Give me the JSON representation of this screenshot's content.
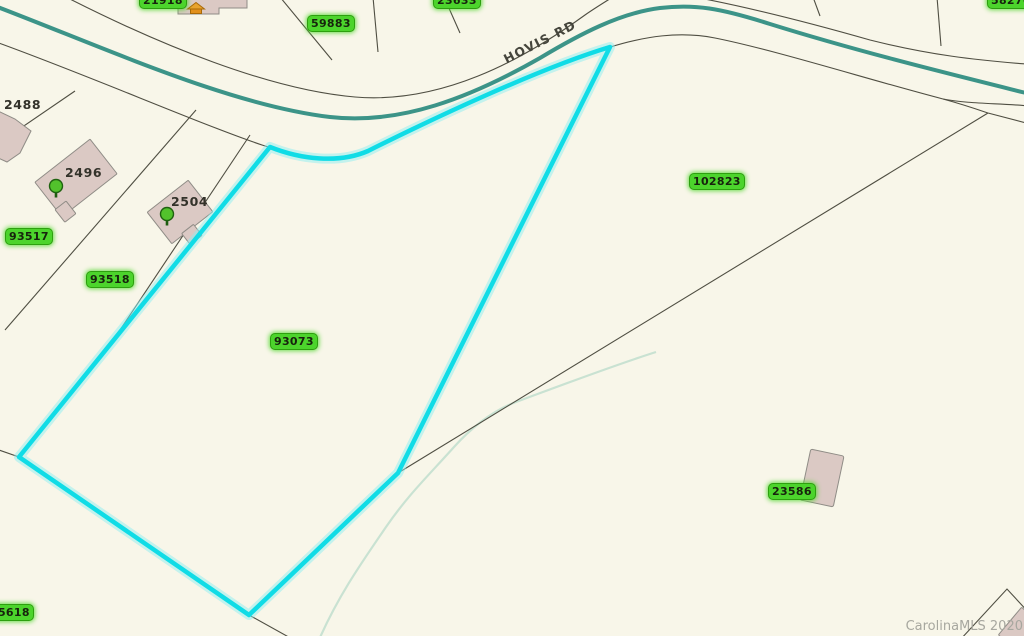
{
  "road": {
    "label": "HOVIS RD"
  },
  "watermark": {
    "label": "CarolinaMLS 2020"
  },
  "parcel_badges": [
    {
      "id": "21918"
    },
    {
      "id": "23633"
    },
    {
      "id": "58276"
    },
    {
      "id": "59883"
    },
    {
      "id": "102823"
    },
    {
      "id": "93073"
    },
    {
      "id": "93517"
    },
    {
      "id": "93518"
    },
    {
      "id": "23586"
    },
    {
      "id": "95618"
    }
  ],
  "address_labels": [
    {
      "number": "2488"
    },
    {
      "number": "2496"
    },
    {
      "number": "2504"
    }
  ],
  "icons": [
    {
      "name": "house-icon"
    },
    {
      "name": "tree-icon"
    }
  ],
  "colors": {
    "background": "#f8f6e9",
    "highlight_parcel_outline": "#10dce6",
    "road_centerline": "#3c9488",
    "parcel_badge_fill": "#4cd42c",
    "building_fill": "#dbc9c4",
    "boundary_line": "#4f4e42",
    "creek": "#c9e2d2",
    "watermark_text": "#a7a79f"
  }
}
